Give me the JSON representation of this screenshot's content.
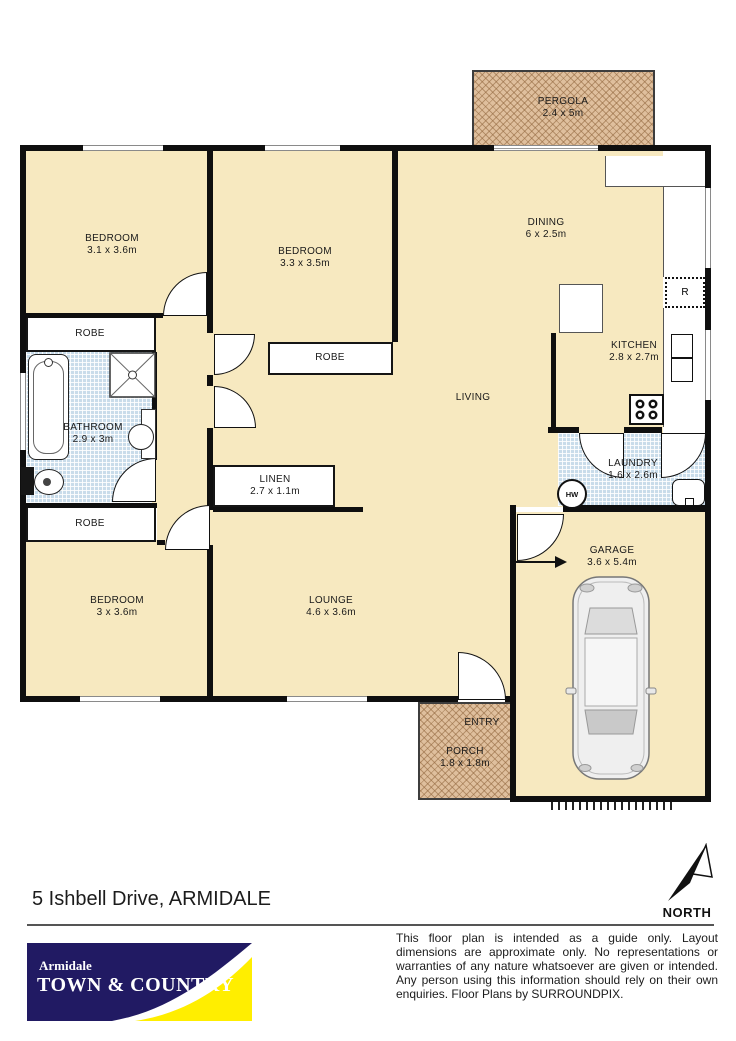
{
  "plan": {
    "pergola": {
      "label": "PERGOLA",
      "dims": "2.4 x 5m"
    },
    "bedroom1": {
      "label": "BEDROOM",
      "dims": "3.1 x 3.6m"
    },
    "bedroom2": {
      "label": "BEDROOM",
      "dims": "3.3 x 3.5m"
    },
    "bedroom3": {
      "label": "BEDROOM",
      "dims": "3 x 3.6m"
    },
    "dining": {
      "label": "DINING",
      "dims": "6 x 2.5m"
    },
    "living": {
      "label": "LIVING"
    },
    "lounge": {
      "label": "LOUNGE",
      "dims": "4.6 x 3.6m"
    },
    "kitchen": {
      "label": "KITCHEN",
      "dims": "2.8 x 2.7m"
    },
    "laundry": {
      "label": "LAUNDRY",
      "dims": "1.6 x 2.6m"
    },
    "bathroom": {
      "label": "BATHROOM",
      "dims": "2.9 x 3m"
    },
    "linen": {
      "label": "LINEN",
      "dims": "2.7 x 1.1m"
    },
    "garage": {
      "label": "GARAGE",
      "dims": "3.6 x 5.4m"
    },
    "porch": {
      "label": "PORCH",
      "dims": "1.8 x 1.8m"
    },
    "entry_label": "ENTRY",
    "robe_label": "ROBE",
    "hot_water_label": "HW",
    "fridge_label": "R",
    "north_label": "NORTH"
  },
  "footer": {
    "address": "5 Ishbell Drive, ARMIDALE",
    "logo_line1": "Armidale",
    "logo_line2": "TOWN & COUNTRY",
    "disclaimer": "This floor plan is intended as a guide only. Layout dimensions are approximate only. No representations or warranties of any nature whatsoever are given or intended. Any person using this information should rely on their own enquiries. Floor Plans by SURROUNDPIX."
  },
  "colors": {
    "floor": "#f7e9c0",
    "tile": "#c9dcea",
    "hatch": "#dfbf9d",
    "wall": "#0f0f0f",
    "logo_navy": "#211a63",
    "logo_yellow": "#ffee00"
  }
}
